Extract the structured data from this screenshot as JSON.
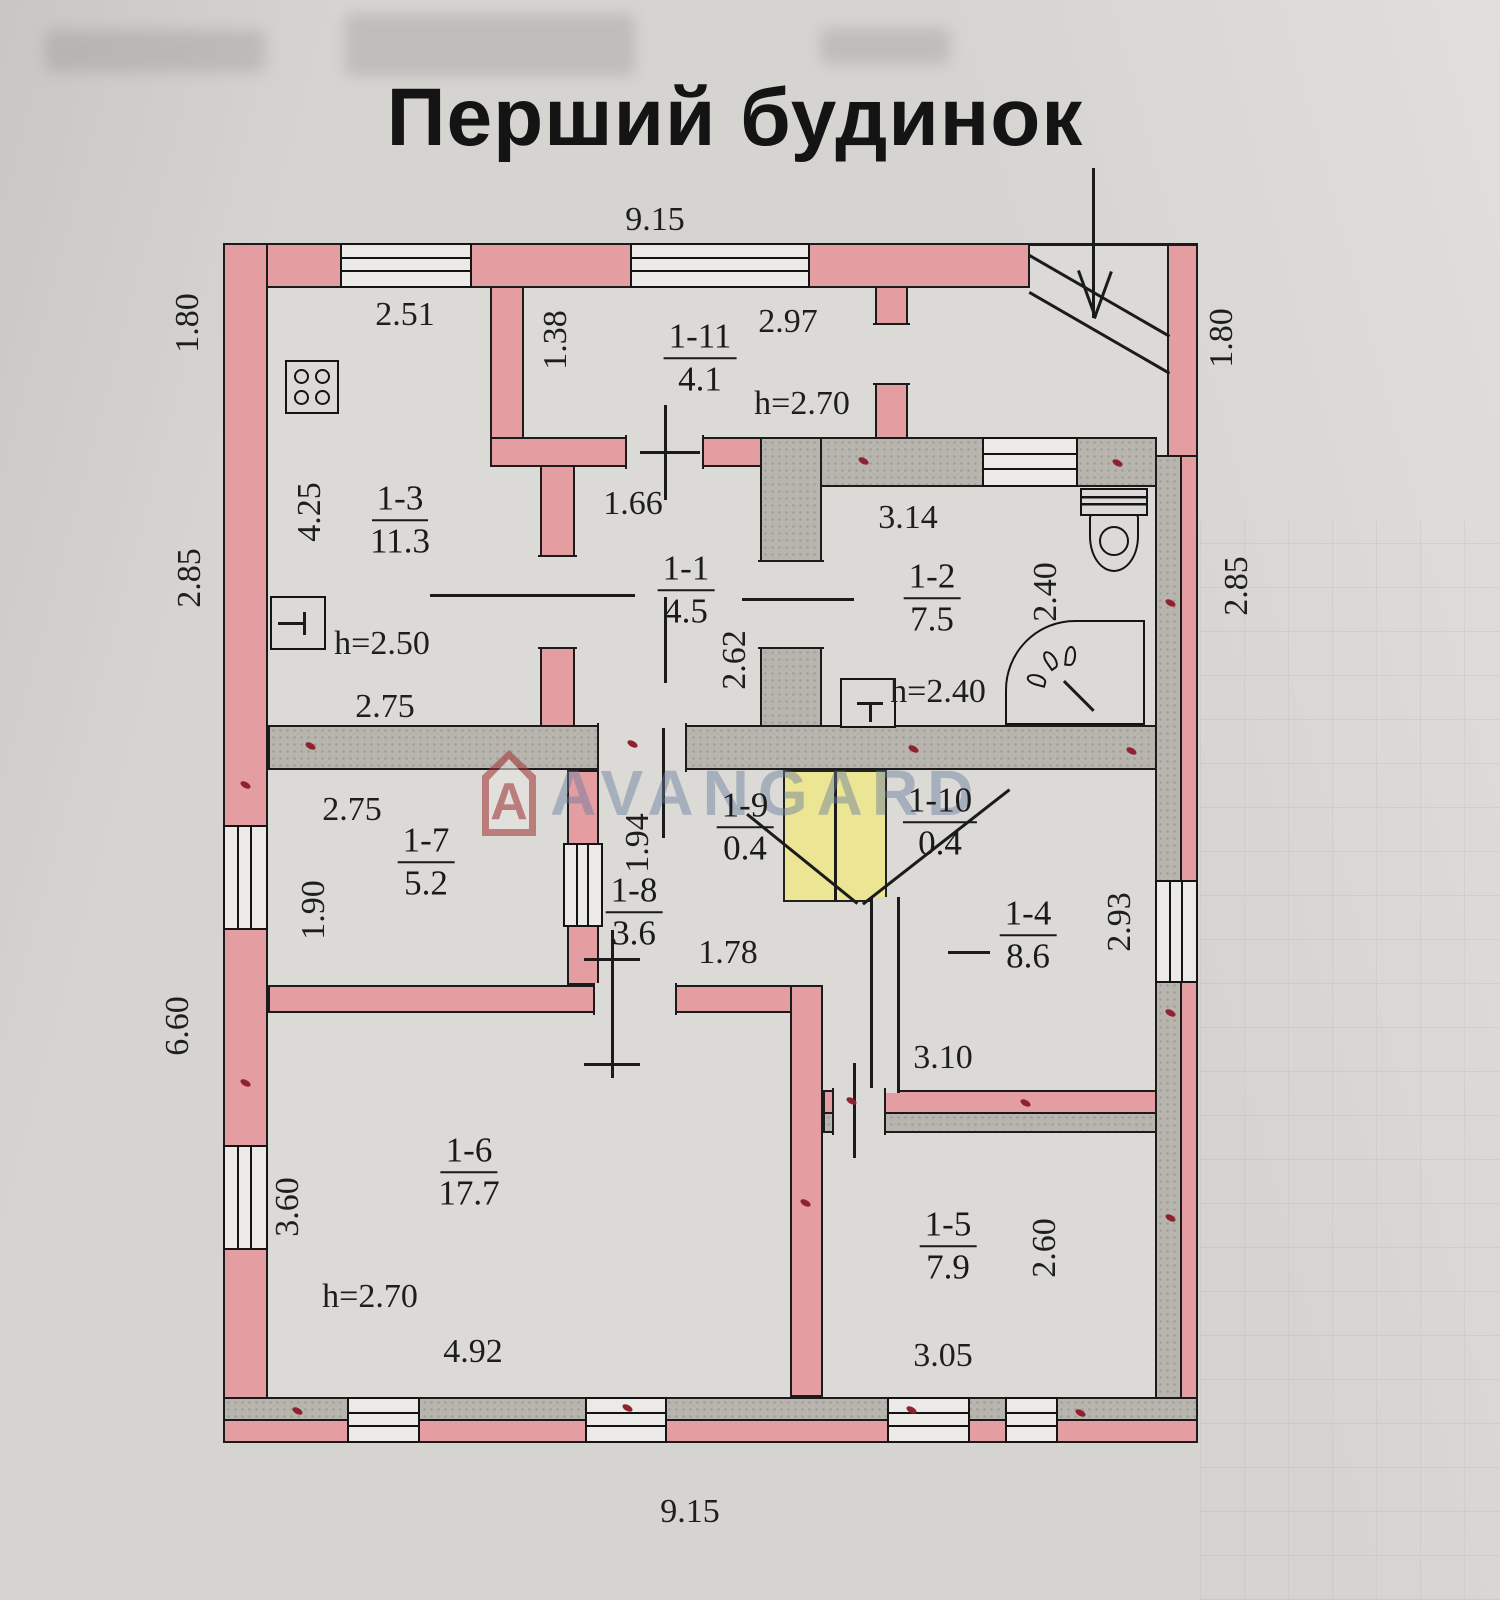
{
  "title": "Перший будинок",
  "watermark": {
    "text": "AVANGARD",
    "logo_letter": "A"
  },
  "icons": [
    "stove-icon",
    "sink-icon",
    "toilet-icon",
    "shower-icon",
    "entrance-arrow-icon"
  ],
  "rooms": {
    "r1": {
      "id": "1-1",
      "area": "4.5"
    },
    "r2": {
      "id": "1-2",
      "area": "7.5",
      "height": "h=2.40"
    },
    "r3": {
      "id": "1-3",
      "area": "11.3",
      "height": "h=2.50"
    },
    "r4": {
      "id": "1-4",
      "area": "8.6"
    },
    "r5": {
      "id": "1-5",
      "area": "7.9"
    },
    "r6": {
      "id": "1-6",
      "area": "17.7",
      "height": "h=2.70"
    },
    "r7": {
      "id": "1-7",
      "area": "5.2"
    },
    "r8": {
      "id": "1-8",
      "area": "3.6"
    },
    "r9": {
      "id": "1-9",
      "area": "0.4"
    },
    "r10": {
      "id": "1-10",
      "area": "0.4"
    },
    "r11": {
      "id": "1-11",
      "area": "4.1",
      "height": "h=2.70"
    }
  },
  "dims": {
    "top_width": "9.15",
    "bottom_width": "9.15",
    "left_top": "1.80",
    "left_mid": "2.85",
    "left_bottom": "6.60",
    "right_top": "1.80",
    "right_mid": "2.85",
    "r3_top": "2.51",
    "r3_left": "4.25",
    "r3_bottom": "2.75",
    "r11_left": "1.38",
    "r11_top": "2.97",
    "r11_door": "1.66",
    "r1_right": "2.62",
    "r2_top": "3.14",
    "r2_right": "2.40",
    "r7_top": "2.75",
    "r7_left": "1.90",
    "r8_left": "1.94",
    "r8_bottom": "1.78",
    "r4_right": "2.93",
    "r4_bottom": "3.10",
    "r6_left": "3.60",
    "r6_bottom": "4.92",
    "r5_right": "2.60",
    "r5_bottom": "3.05"
  },
  "colors": {
    "paper": "#d6d4d1",
    "line": "#1b1b1b",
    "wall_exterior_pink": "#e49da1",
    "wall_interior_gray": "#b8b4ae",
    "closet_highlight_yellow": "#ece594",
    "wall_marker_red": "#8d2331",
    "watermark_blue": "#667c9c",
    "watermark_logo_red": "#a03737"
  }
}
